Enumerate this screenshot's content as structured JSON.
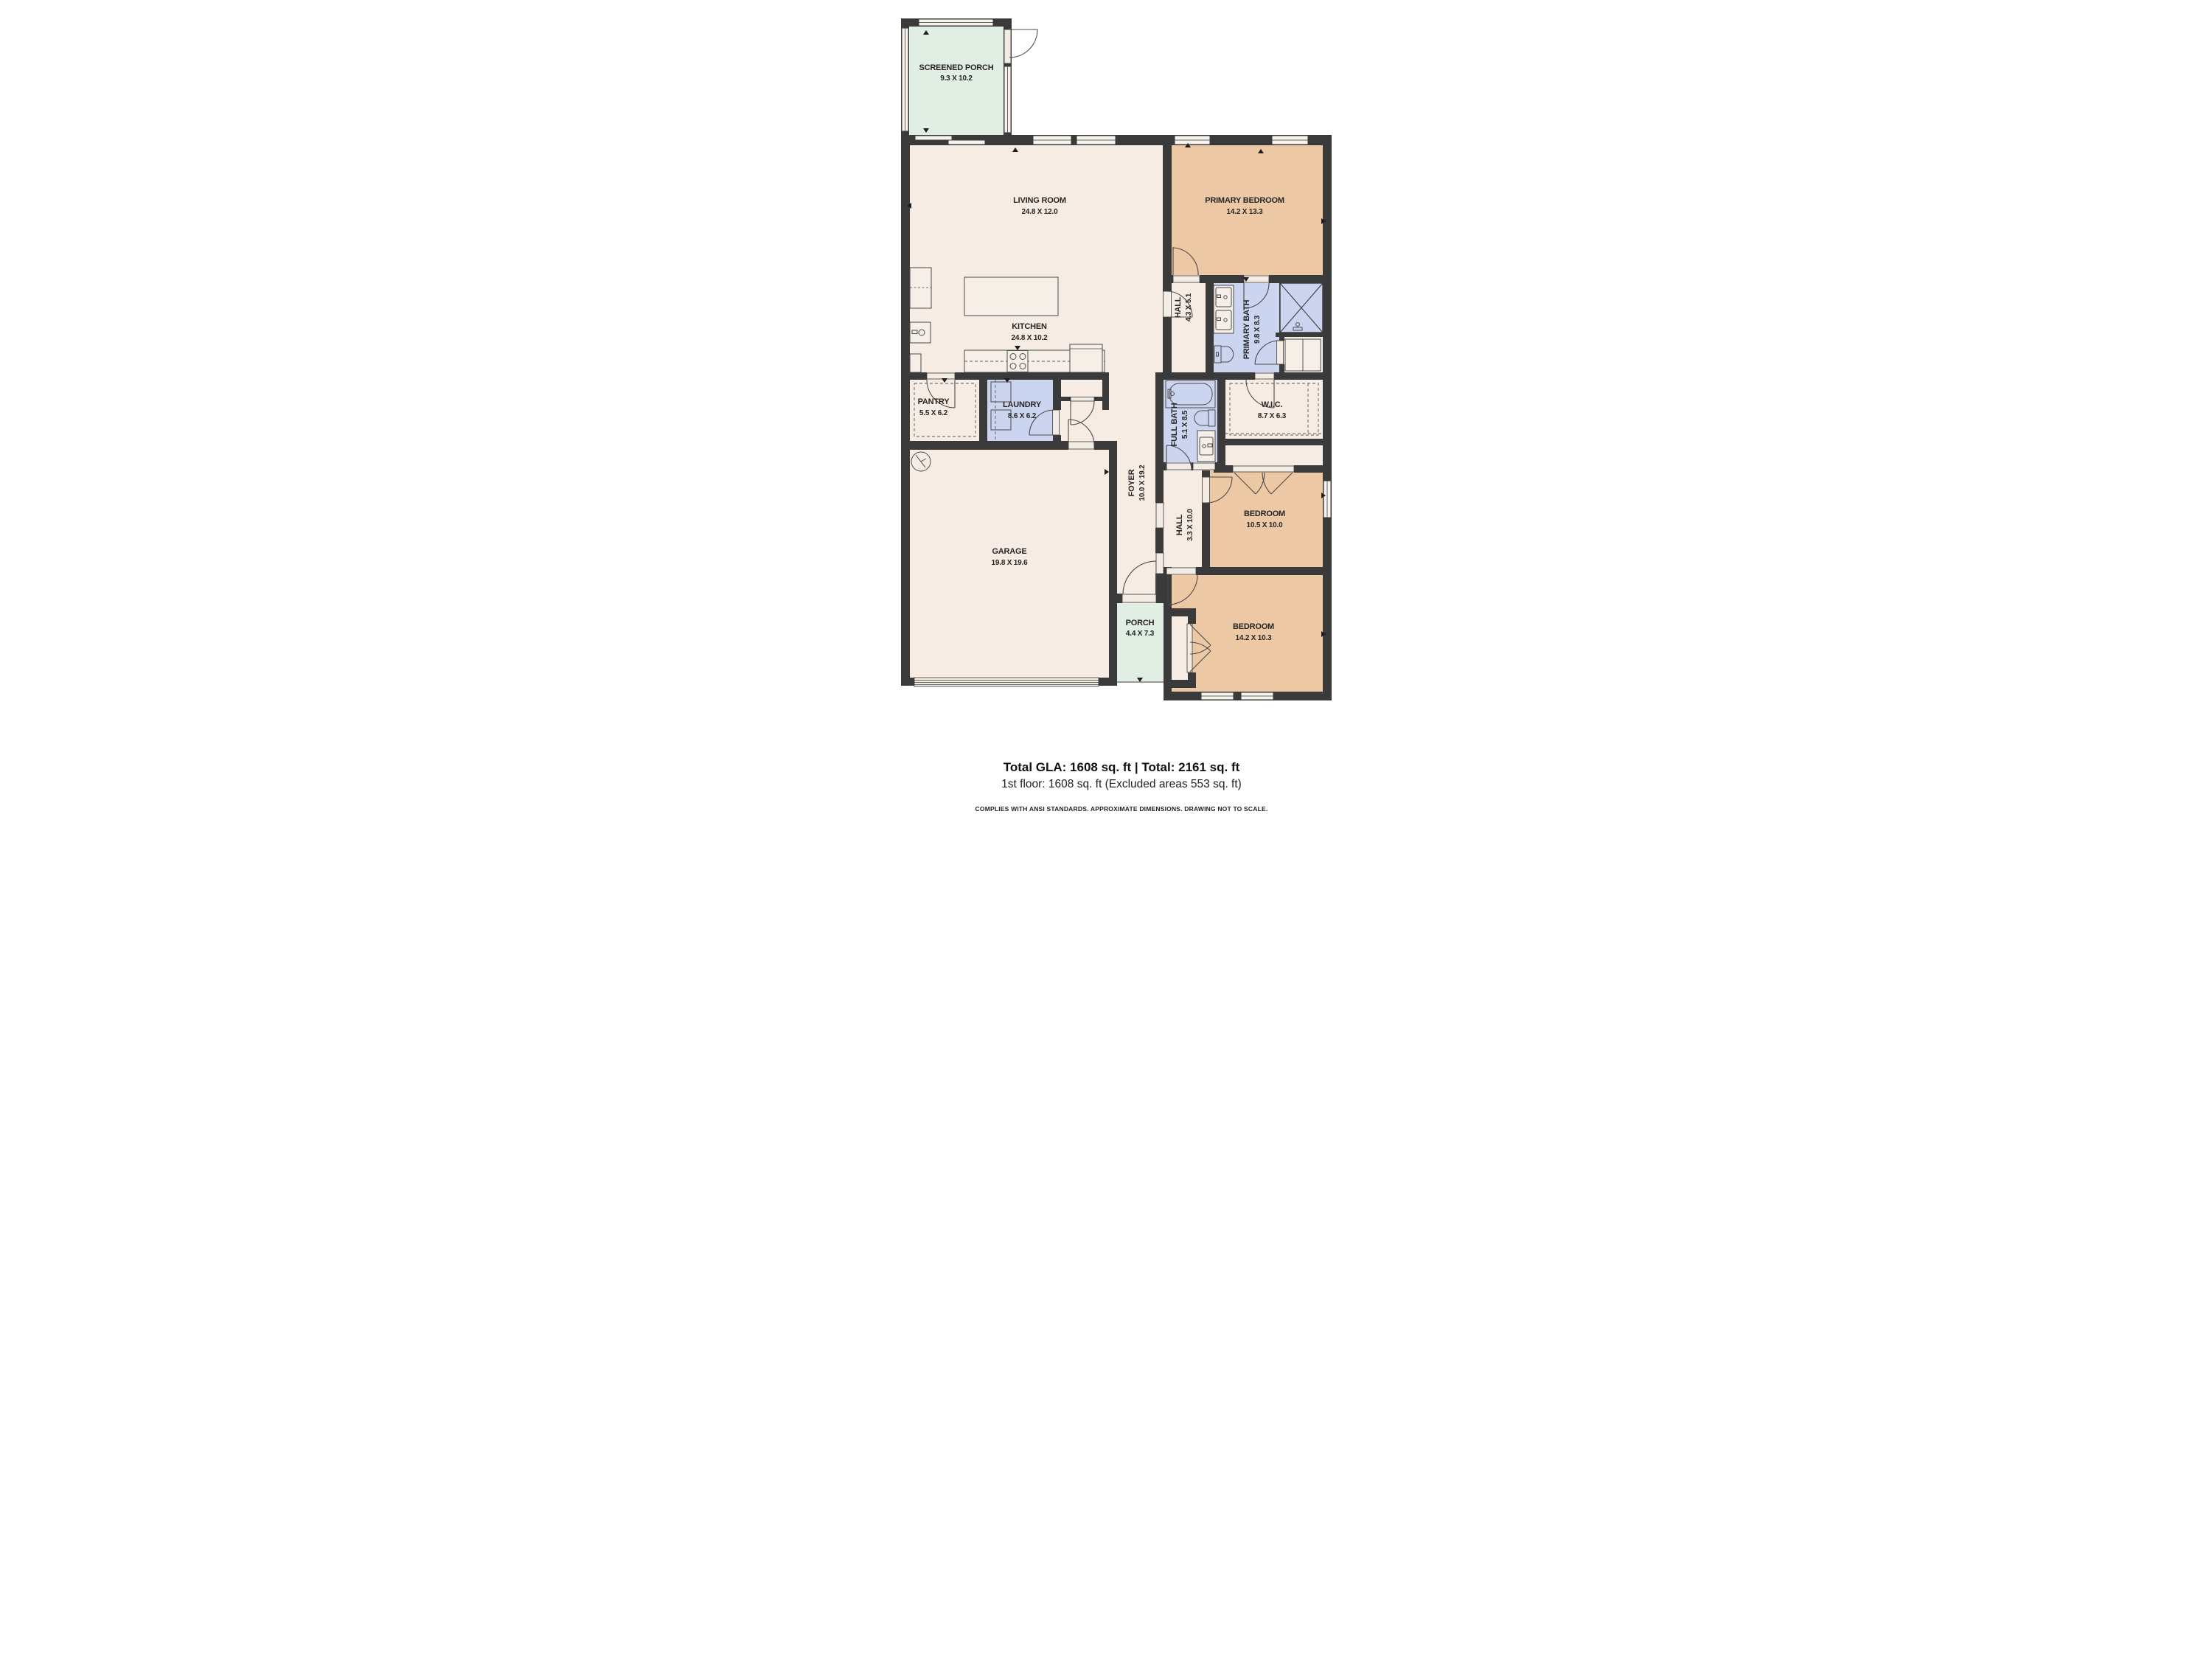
{
  "rooms": [
    {
      "id": "screened-porch",
      "name": "SCREENED PORCH",
      "dims": "9.3 X 10.2"
    },
    {
      "id": "living-room",
      "name": "LIVING ROOM",
      "dims": "24.8 X 12.0"
    },
    {
      "id": "primary-bedroom",
      "name": "PRIMARY BEDROOM",
      "dims": "14.2 X 13.3"
    },
    {
      "id": "kitchen",
      "name": "KITCHEN",
      "dims": "24.8 X 10.2"
    },
    {
      "id": "hall-upper",
      "name": "HALL",
      "dims": "4.3 X 5.1"
    },
    {
      "id": "primary-bath",
      "name": "PRIMARY BATH",
      "dims": "9.8 X 8.3"
    },
    {
      "id": "pantry",
      "name": "PANTRY",
      "dims": "5.5 X 6.2"
    },
    {
      "id": "laundry",
      "name": "LAUNDRY",
      "dims": "8.6 X 6.2"
    },
    {
      "id": "full-bath",
      "name": "FULL BATH",
      "dims": "5.1 X 8.5"
    },
    {
      "id": "wic",
      "name": "W.I.C.",
      "dims": "8.7 X 6.3"
    },
    {
      "id": "foyer",
      "name": "FOYER",
      "dims": "10.0 X 19.2"
    },
    {
      "id": "hall-lower",
      "name": "HALL",
      "dims": "3.3 X 10.0"
    },
    {
      "id": "bedroom-mid",
      "name": "BEDROOM",
      "dims": "10.5 X 10.0"
    },
    {
      "id": "garage",
      "name": "GARAGE",
      "dims": "19.8 X 19.6"
    },
    {
      "id": "porch",
      "name": "PORCH",
      "dims": "4.4 X 7.3"
    },
    {
      "id": "bedroom-bottom",
      "name": "BEDROOM",
      "dims": "14.2 X 10.3"
    }
  ],
  "footer": {
    "line1": "Total GLA: 1608 sq. ft | Total: 2161 sq. ft",
    "line2": "1st floor: 1608 sq. ft (Excluded areas 553 sq. ft)",
    "disclaimer": "COMPLIES WITH ANSI STANDARDS. APPROXIMATE DIMENSIONS. DRAWING NOT TO SCALE."
  },
  "colors": {
    "wall": "#3a3a3a",
    "floor": "#f6ece3",
    "bedroom": "#edc8a5",
    "wet_room": "#cbd5f0",
    "porch": "#e0eee3",
    "background": "#ffffff"
  }
}
